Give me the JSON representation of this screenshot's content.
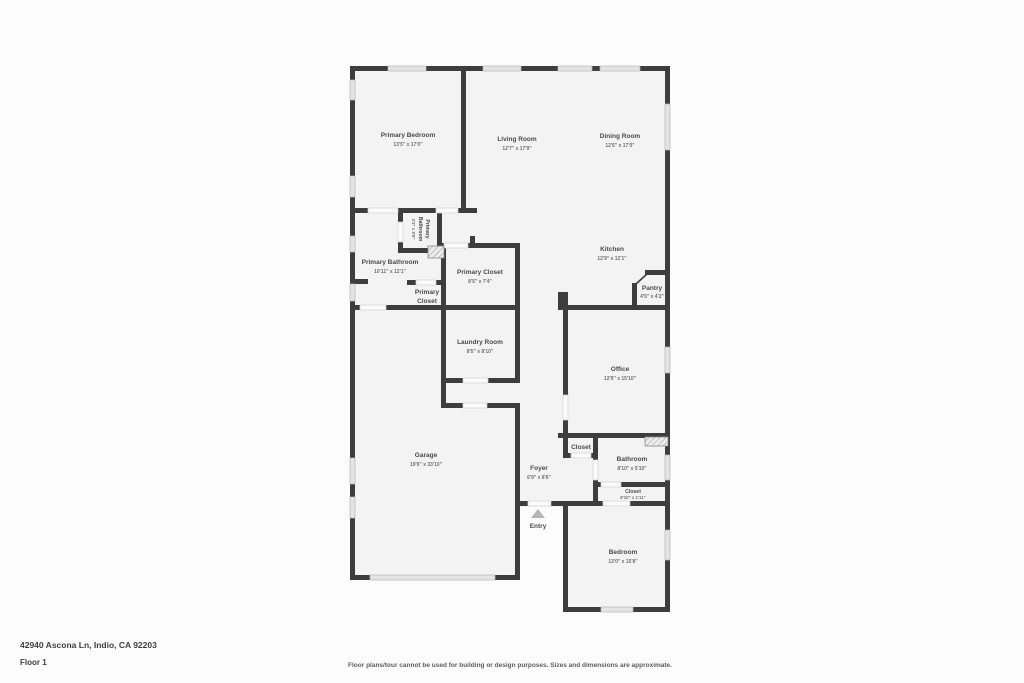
{
  "footer": {
    "address": "42940 Ascona Ln, Indio, CA 92203",
    "floor_label": "Floor 1",
    "disclaimer": "Floor plans/tour cannot be used for building or design purposes. Sizes and dimensions are approximate."
  },
  "entry": {
    "label": "Entry"
  },
  "rooms": {
    "primary_bedroom": {
      "name": "Primary Bedroom",
      "dims": "13'5\" x 17'0\""
    },
    "living_room": {
      "name": "Living Room",
      "dims": "12'7\" x 17'9\""
    },
    "dining_room": {
      "name": "Dining Room",
      "dims": "12'6\" x 17'0\""
    },
    "primary_bathroom_small": {
      "line1": "Primary",
      "line2": "Bathroom",
      "dims": "3'3\" x 5'6\""
    },
    "primary_bathroom": {
      "name": "Primary Bathroom",
      "dims": "10'11\" x 12'1\""
    },
    "primary_closet": {
      "name": "Primary Closet",
      "dims": "8'5\" x 7'4\""
    },
    "primary_closet_small": {
      "line1": "Primary",
      "line2": "Closet"
    },
    "kitchen": {
      "name": "Kitchen",
      "dims": "12'9\" x 12'1\""
    },
    "pantry": {
      "name": "Pantry",
      "dims": "4'5\" x 4'2\""
    },
    "laundry_room": {
      "name": "Laundry Room",
      "dims": "8'5\" x 8'10\""
    },
    "office": {
      "name": "Office",
      "dims": "12'9\" x 15'10\""
    },
    "garage": {
      "name": "Garage",
      "dims": "19'9\" x 33'10\""
    },
    "foyer": {
      "name": "Foyer",
      "dims": "6'9\" x 8'6\""
    },
    "closet_hall": {
      "name": "Closet"
    },
    "bathroom": {
      "name": "Bathroom",
      "dims": "8'10\" x 5'10\""
    },
    "closet_bedroom": {
      "name": "Closet",
      "dims": "8'10\" x 1'11\""
    },
    "bedroom": {
      "name": "Bedroom",
      "dims": "13'0\" x 15'8\""
    }
  },
  "colors": {
    "wall": "#3d3d3d",
    "floor": "#f3f3f3",
    "window": "#e4e4e4",
    "background": "#fcfcfc",
    "label_text": "#4a4a4a"
  }
}
